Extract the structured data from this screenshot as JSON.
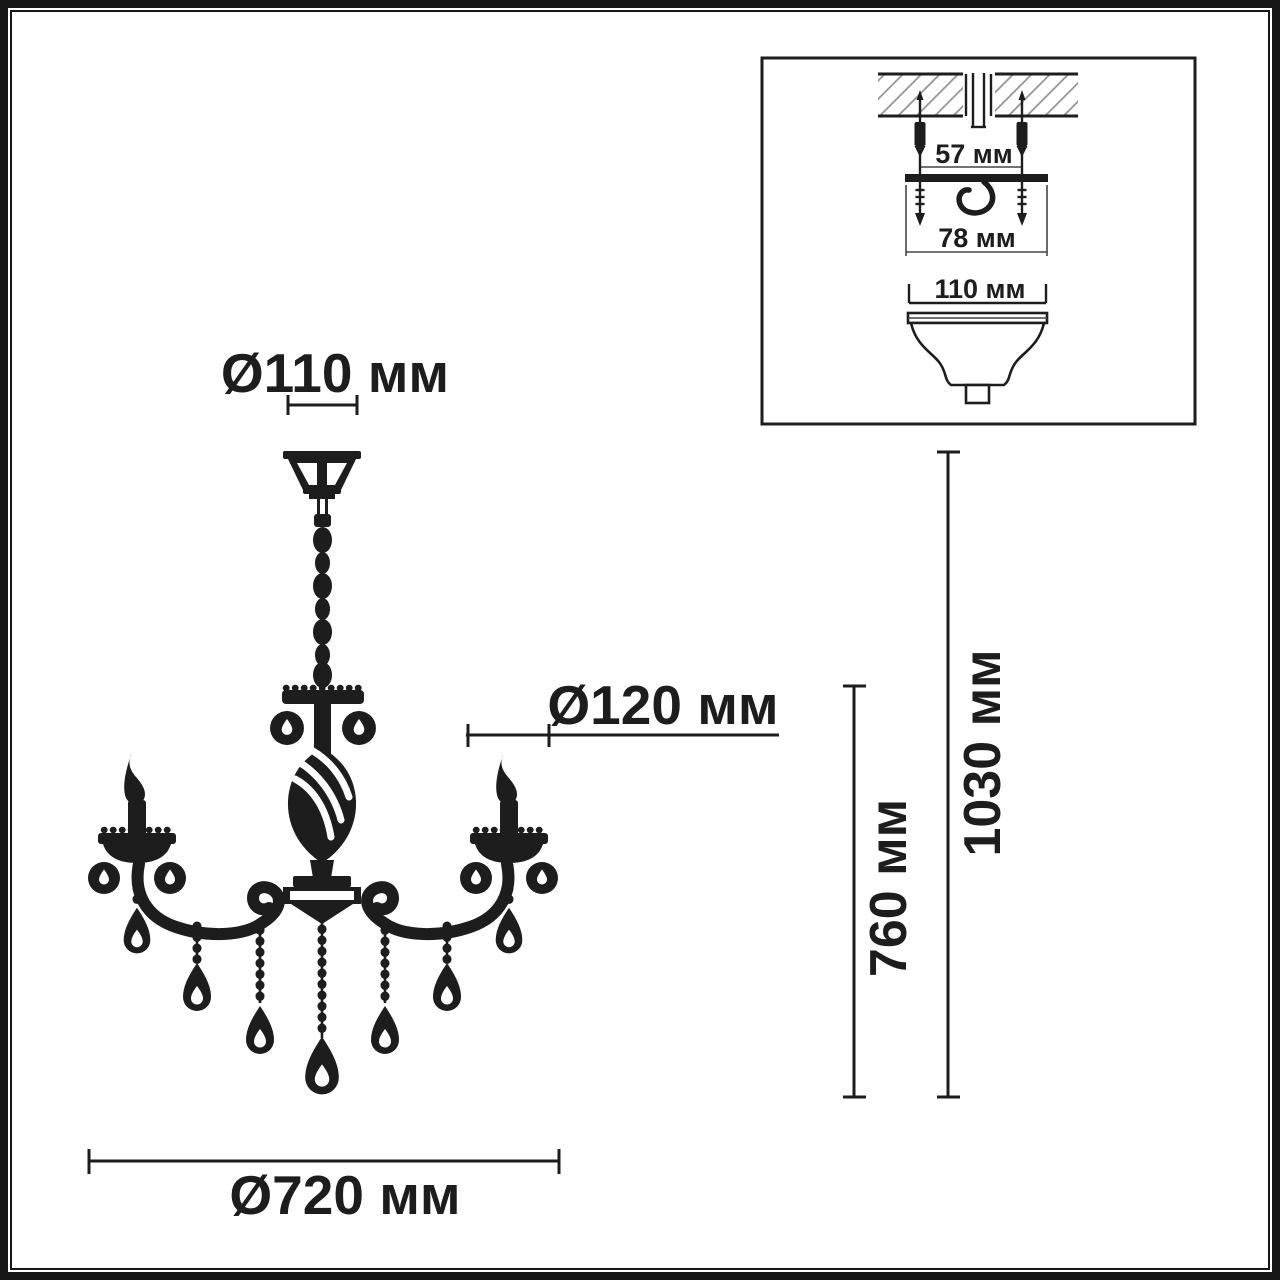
{
  "page": {
    "background": "#ffffff",
    "ink": "#1d1d1d",
    "hatch_color": "#8f8f8f"
  },
  "chandelier_view": {
    "label_canopy_diameter": "Ø110 мм",
    "label_sconce_diameter": "Ø120 мм",
    "label_fixture_diameter": "Ø720 мм",
    "label_body_height": "760 мм",
    "label_overall_height": "1030 мм"
  },
  "mounting_inset": {
    "label_anchor_spacing": "57 мм",
    "label_bracket_length": "78 мм",
    "label_canopy_diameter": "110 мм"
  }
}
